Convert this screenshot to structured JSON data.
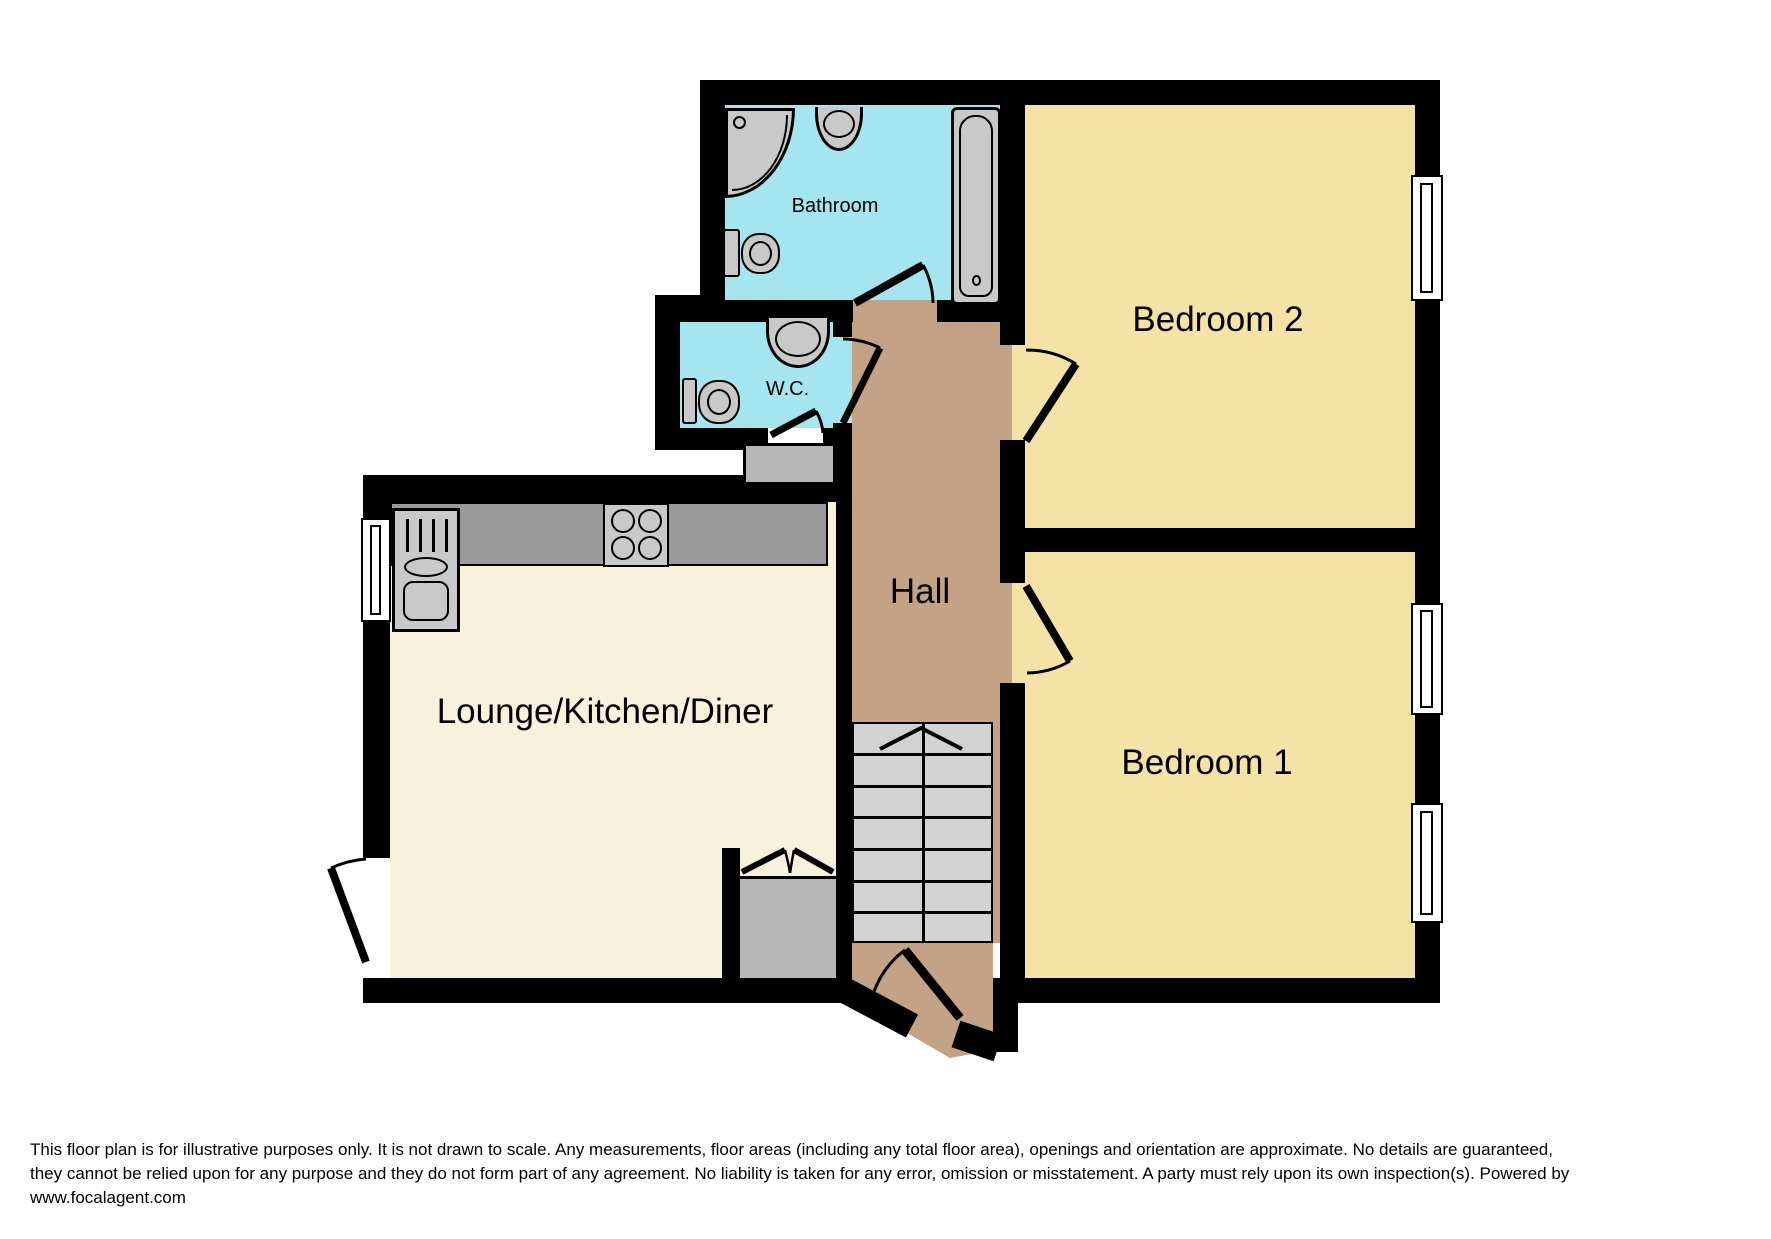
{
  "colors": {
    "background": "#FFFFFF",
    "wall": "#000000",
    "bathroom-floor": "#A5E5F0",
    "bedroom-floor": "#F5E2A6",
    "lounge-floor": "#F8F2DC",
    "hall-floor": "#C3A285",
    "fixture": "#C9C9C9",
    "counter": "#9B9B9B",
    "stairs": "#D2D2D2",
    "cupboard": "#B6B6B6",
    "window": "#FFFFFF"
  },
  "rooms": {
    "bathroom": {
      "label": "Bathroom"
    },
    "wc": {
      "label": "W.C."
    },
    "bedroom2": {
      "label": "Bedroom 2"
    },
    "bedroom1": {
      "label": "Bedroom 1"
    },
    "hall": {
      "label": "Hall"
    },
    "lounge": {
      "label": "Lounge/Kitchen/Diner"
    }
  },
  "disclaimer": {
    "line1": "This floor plan is for illustrative purposes only. It is not drawn to scale. Any measurements, floor areas (including any total floor area), openings and orientation are approximate. No details are guaranteed,",
    "line2": "they cannot be relied upon for any purpose and they do not form part of any agreement. No liability is taken for any error, omission or misstatement. A party must rely upon its own inspection(s). Powered by",
    "line3": "www.focalagent.com"
  }
}
